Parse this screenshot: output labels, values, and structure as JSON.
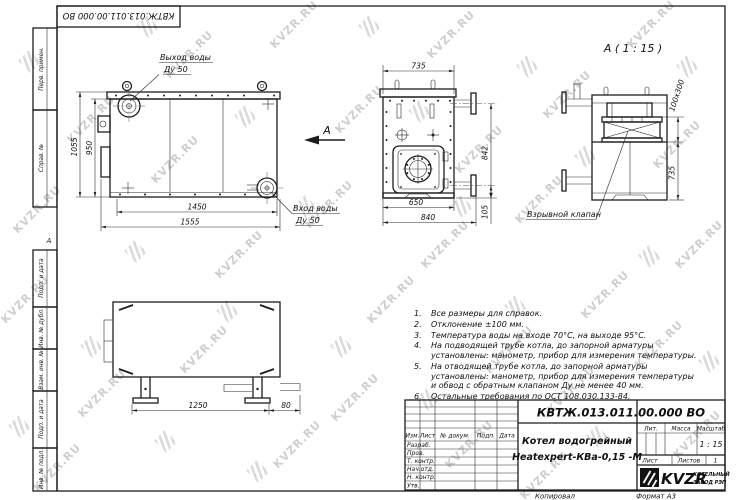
{
  "watermark": {
    "text": "KVZR.RU"
  },
  "frame": {
    "top_code": "КВТЖ.013.011.00.000 ВО",
    "zone_letter": "А",
    "left_labels": [
      "Перв. примен.",
      "Справ. №",
      "Подп. и дата",
      "Инв. № дубл.",
      "Взам. инв. №",
      "Подп. и дата",
      "Инв. № подл."
    ]
  },
  "views": {
    "front": {
      "outlet_label": "Выход воды",
      "outlet_dn": "Ду 50",
      "inlet_label": "Вход воды",
      "inlet_dn": "Ду 50",
      "view_arrow": "А",
      "dims": {
        "height_outer": "1055",
        "height_inner": "950",
        "width_inner": "1450",
        "width_outer": "1555"
      }
    },
    "side": {
      "dims": {
        "width_top": "735",
        "height": "842",
        "width_bottom_inner": "650",
        "width_bottom_outer": "840",
        "pipe_offset": "105"
      }
    },
    "rear": {
      "title": "А ( 1 : 15 )",
      "valve_label": "Взрывной клапан",
      "dims": {
        "valve_size": "100х300",
        "height": "735"
      }
    },
    "bottom": {
      "dims": {
        "leg_span": "1250",
        "edge_offset": "80"
      }
    }
  },
  "notes": {
    "items": [
      {
        "num": "1.",
        "text": "Все размеры для справок."
      },
      {
        "num": "2.",
        "text": "Отклонение ±100 мм."
      },
      {
        "num": "3.",
        "text": "Температура воды на входе 70°С, на выходе 95°С."
      },
      {
        "num": "4.",
        "text": "На подводящей трубе котла, до запорной арматуры установлены: манометр, прибор для измерения температуры."
      },
      {
        "num": "5.",
        "text": "На отводящей трубе котла, до запорной арматуры установлены: манометр, прибор для измерения температуры и обвод с обратным клапаном Ду не менее 40 мм."
      },
      {
        "num": "6.",
        "text": "Остальные требования по ОСТ 108.030.133-84."
      }
    ]
  },
  "title_block": {
    "code": "КВТЖ.013.011.00.000 ВО",
    "name_line1": "Котел водогрейный",
    "name_line2": "Heatexpert-КВа-0,15 -М",
    "header_cols": [
      "Изм.",
      "Лист",
      "№ докум.",
      "Подп.",
      "Дата"
    ],
    "sign_rows": [
      "Разраб.",
      "Пров.",
      "Т. контр.",
      "Нач.отд.",
      "Н. контр.",
      "Утв."
    ],
    "lit_label": "Лит.",
    "mass_label": "Масса",
    "scale_label": "Масштаб",
    "scale_value": "1 : 15",
    "sheet_label": "Лист",
    "sheets_label": "Листов",
    "sheets_value": "1",
    "logo_text": "KVZR",
    "logo_sub1": "КОТЕЛЬНЫЙ",
    "logo_sub2": "ЗАВОД РЭП"
  },
  "footer": {
    "copied": "Копировал",
    "format": "Формат А3"
  }
}
